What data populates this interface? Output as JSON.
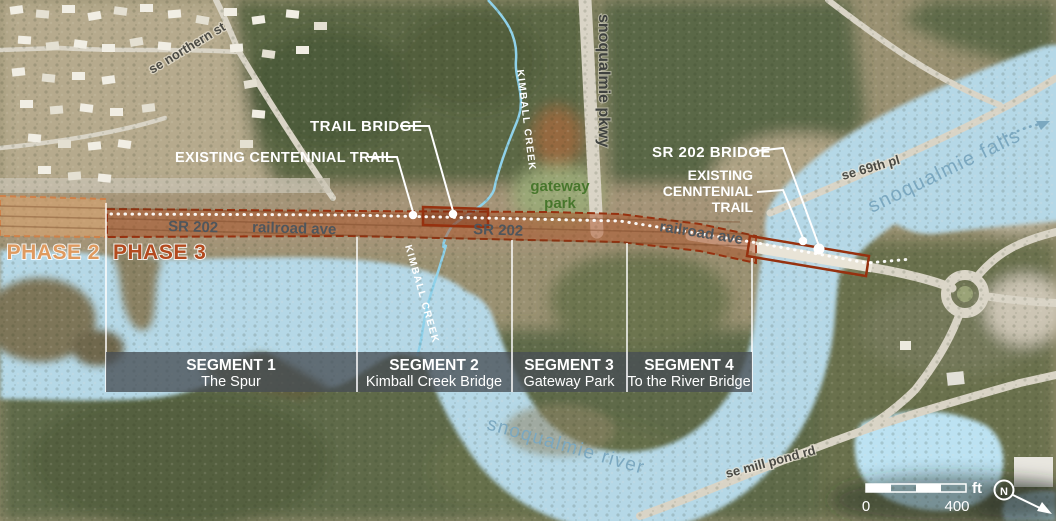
{
  "phases": {
    "phase2": "PHASE 2",
    "phase3": "PHASE 3"
  },
  "corridor": {
    "sr202_a": "SR 202",
    "railroad_ave_a": "railroad ave",
    "sr202_b": "SR 202",
    "railroad_ave_b": "railroad ave"
  },
  "callouts": {
    "trail_bridge": "TRAIL BRIDGE",
    "existing_centennial_trail": "EXISTING CENTENNIAL TRAIL",
    "sr202_bridge": "SR 202 BRIDGE",
    "existing_cenntenial_l1": "EXISTING",
    "existing_cenntenial_l2": "CENNTENIAL",
    "existing_cenntenial_l3": "TRAIL"
  },
  "places": {
    "se_northern_st": "se northern st",
    "snoqualmie_pkwy": "snoqualmie pkwy",
    "kimball_creek_upper": "KIMBALL CREEK",
    "kimball_creek_lower": "KIMBALL CREEK",
    "gateway_l1": "gateway",
    "gateway_l2": "park",
    "se_69th_pl": "se 69th pl",
    "snoqualmie_falls": "snoqualmie falls",
    "snoqualmie_river": "snoqualmie river",
    "se_mill_pond_rd": "se mill pond rd"
  },
  "segments": [
    {
      "name": "SEGMENT 1",
      "subtitle": "The Spur"
    },
    {
      "name": "SEGMENT 2",
      "subtitle": "Kimball Creek Bridge"
    },
    {
      "name": "SEGMENT 3",
      "subtitle": "Gateway Park"
    },
    {
      "name": "SEGMENT 4",
      "subtitle": "To the River Bridge"
    }
  ],
  "scalebar": {
    "start": "0",
    "end": "400",
    "unit": "ft",
    "north": "N"
  },
  "colors": {
    "phase2_text": "#df9a5f",
    "phase3_text": "#b34a1e",
    "water": "#b5d8e7",
    "corridor_border": "#9c2c0c",
    "segment_bar": "rgba(72,78,84,0.78)"
  }
}
